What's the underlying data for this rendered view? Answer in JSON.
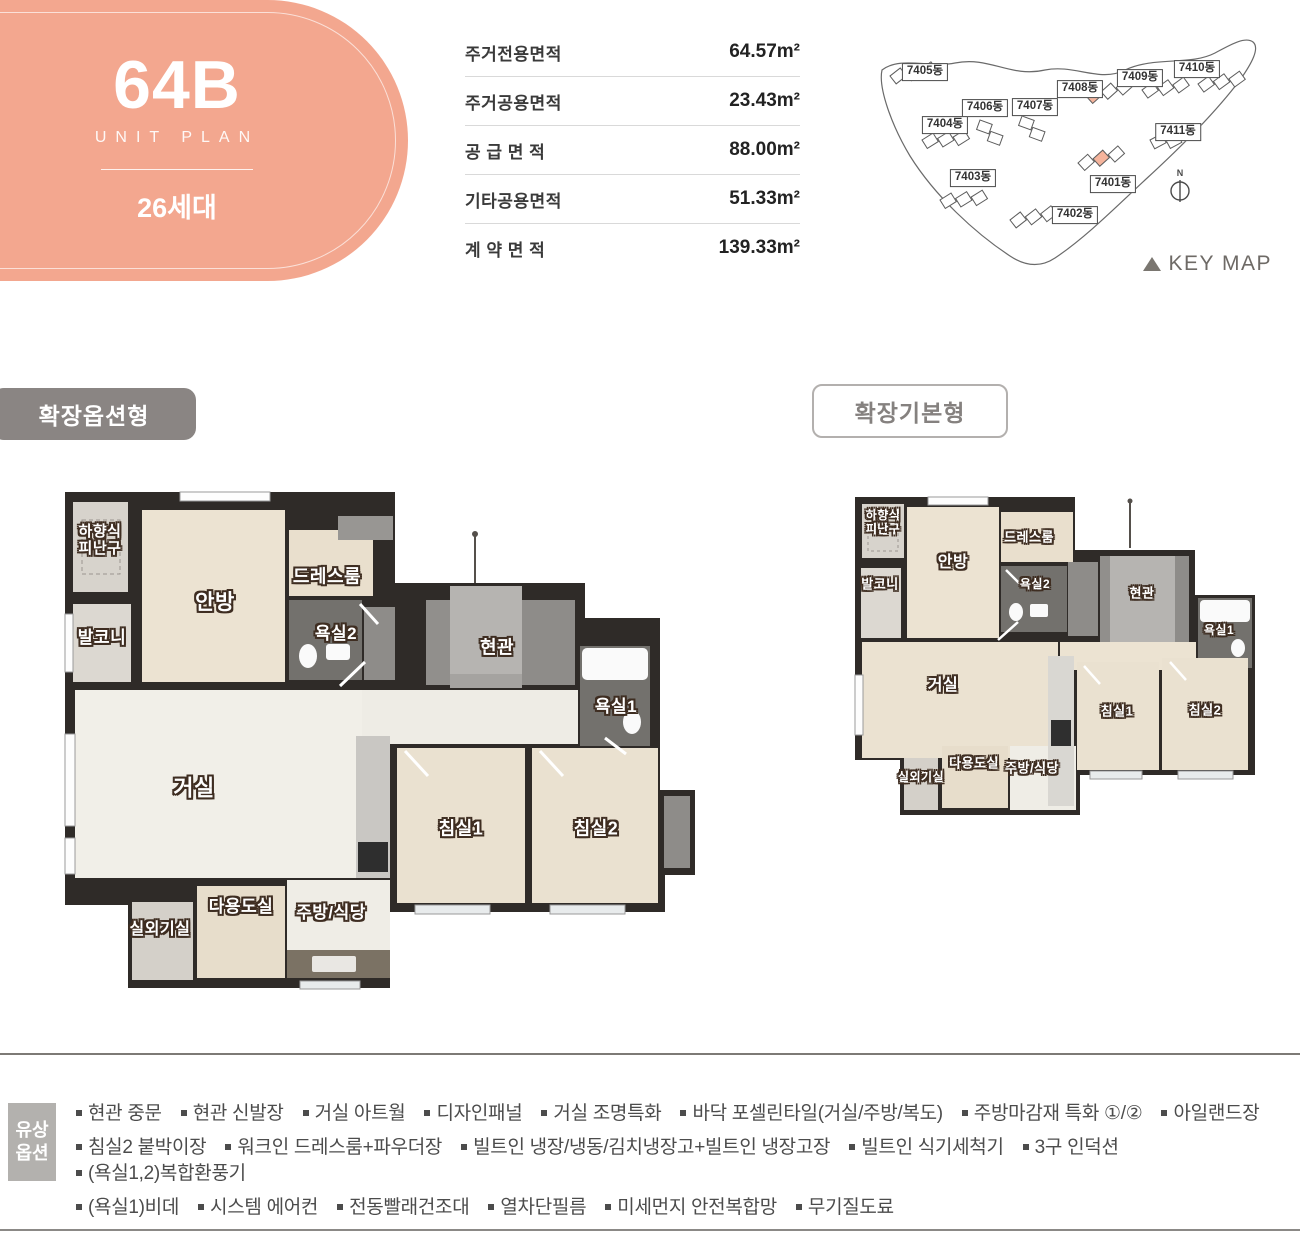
{
  "unit": {
    "name": "64B",
    "subtitle": "UNIT PLAN",
    "households": "26세대"
  },
  "area_table": {
    "rows": [
      {
        "label": "주거전용면적",
        "value": "64.57m²"
      },
      {
        "label": "주거공용면적",
        "value": "23.43m²"
      },
      {
        "label": "공 급 면 적",
        "value": "88.00m²"
      },
      {
        "label": "기타공용면적",
        "value": "51.33m²"
      },
      {
        "label": "계 약 면 적",
        "value": "139.33m²"
      }
    ]
  },
  "keymap": {
    "title": "KEY MAP",
    "north_label": "N",
    "buildings": [
      "7405동",
      "7406동",
      "7407동",
      "7404동",
      "7403동",
      "7402동",
      "7401동",
      "7408동",
      "7409동",
      "7410동",
      "7411동"
    ]
  },
  "sections": {
    "option_title": "확장옵션형",
    "basic_title": "확장기본형"
  },
  "rooms": {
    "escape": "하향식\n피난구",
    "balcony": "발코니",
    "master": "안방",
    "dress": "드레스룸",
    "bath2": "욕실2",
    "entrance": "현관",
    "bath1": "욕실1",
    "living": "거실",
    "bed1": "침실1",
    "bed2": "침실2",
    "utility": "다용도실",
    "kitchen": "주방/식당",
    "outdoor": "실외기실"
  },
  "paid_options": {
    "badge": "유상\n옵션",
    "lines": [
      [
        "현관 중문",
        "현관 신발장",
        "거실 아트월",
        "디자인패널",
        "거실 조명특화",
        "바닥 포셀린타일(거실/주방/복도)",
        "주방마감재 특화 ①/②",
        "아일랜드장"
      ],
      [
        "침실2 붙박이장",
        "워크인 드레스룸+파우더장",
        "빌트인 냉장/냉동/김치냉장고+빌트인 냉장고장",
        "빌트인 식기세척기",
        "3구 인덕션",
        "(욕실1,2)복합환풍기"
      ],
      [
        "(욕실1)비데",
        "시스템 에어컨",
        "전동빨래건조대",
        "열차단필름",
        "미세먼지 안전복합망",
        "무기질도료"
      ]
    ]
  },
  "colors": {
    "accent": "#f3a78f",
    "highlight": "#f5b49c",
    "badge_gray": "#8a8583",
    "wall": "#2f2b28"
  }
}
